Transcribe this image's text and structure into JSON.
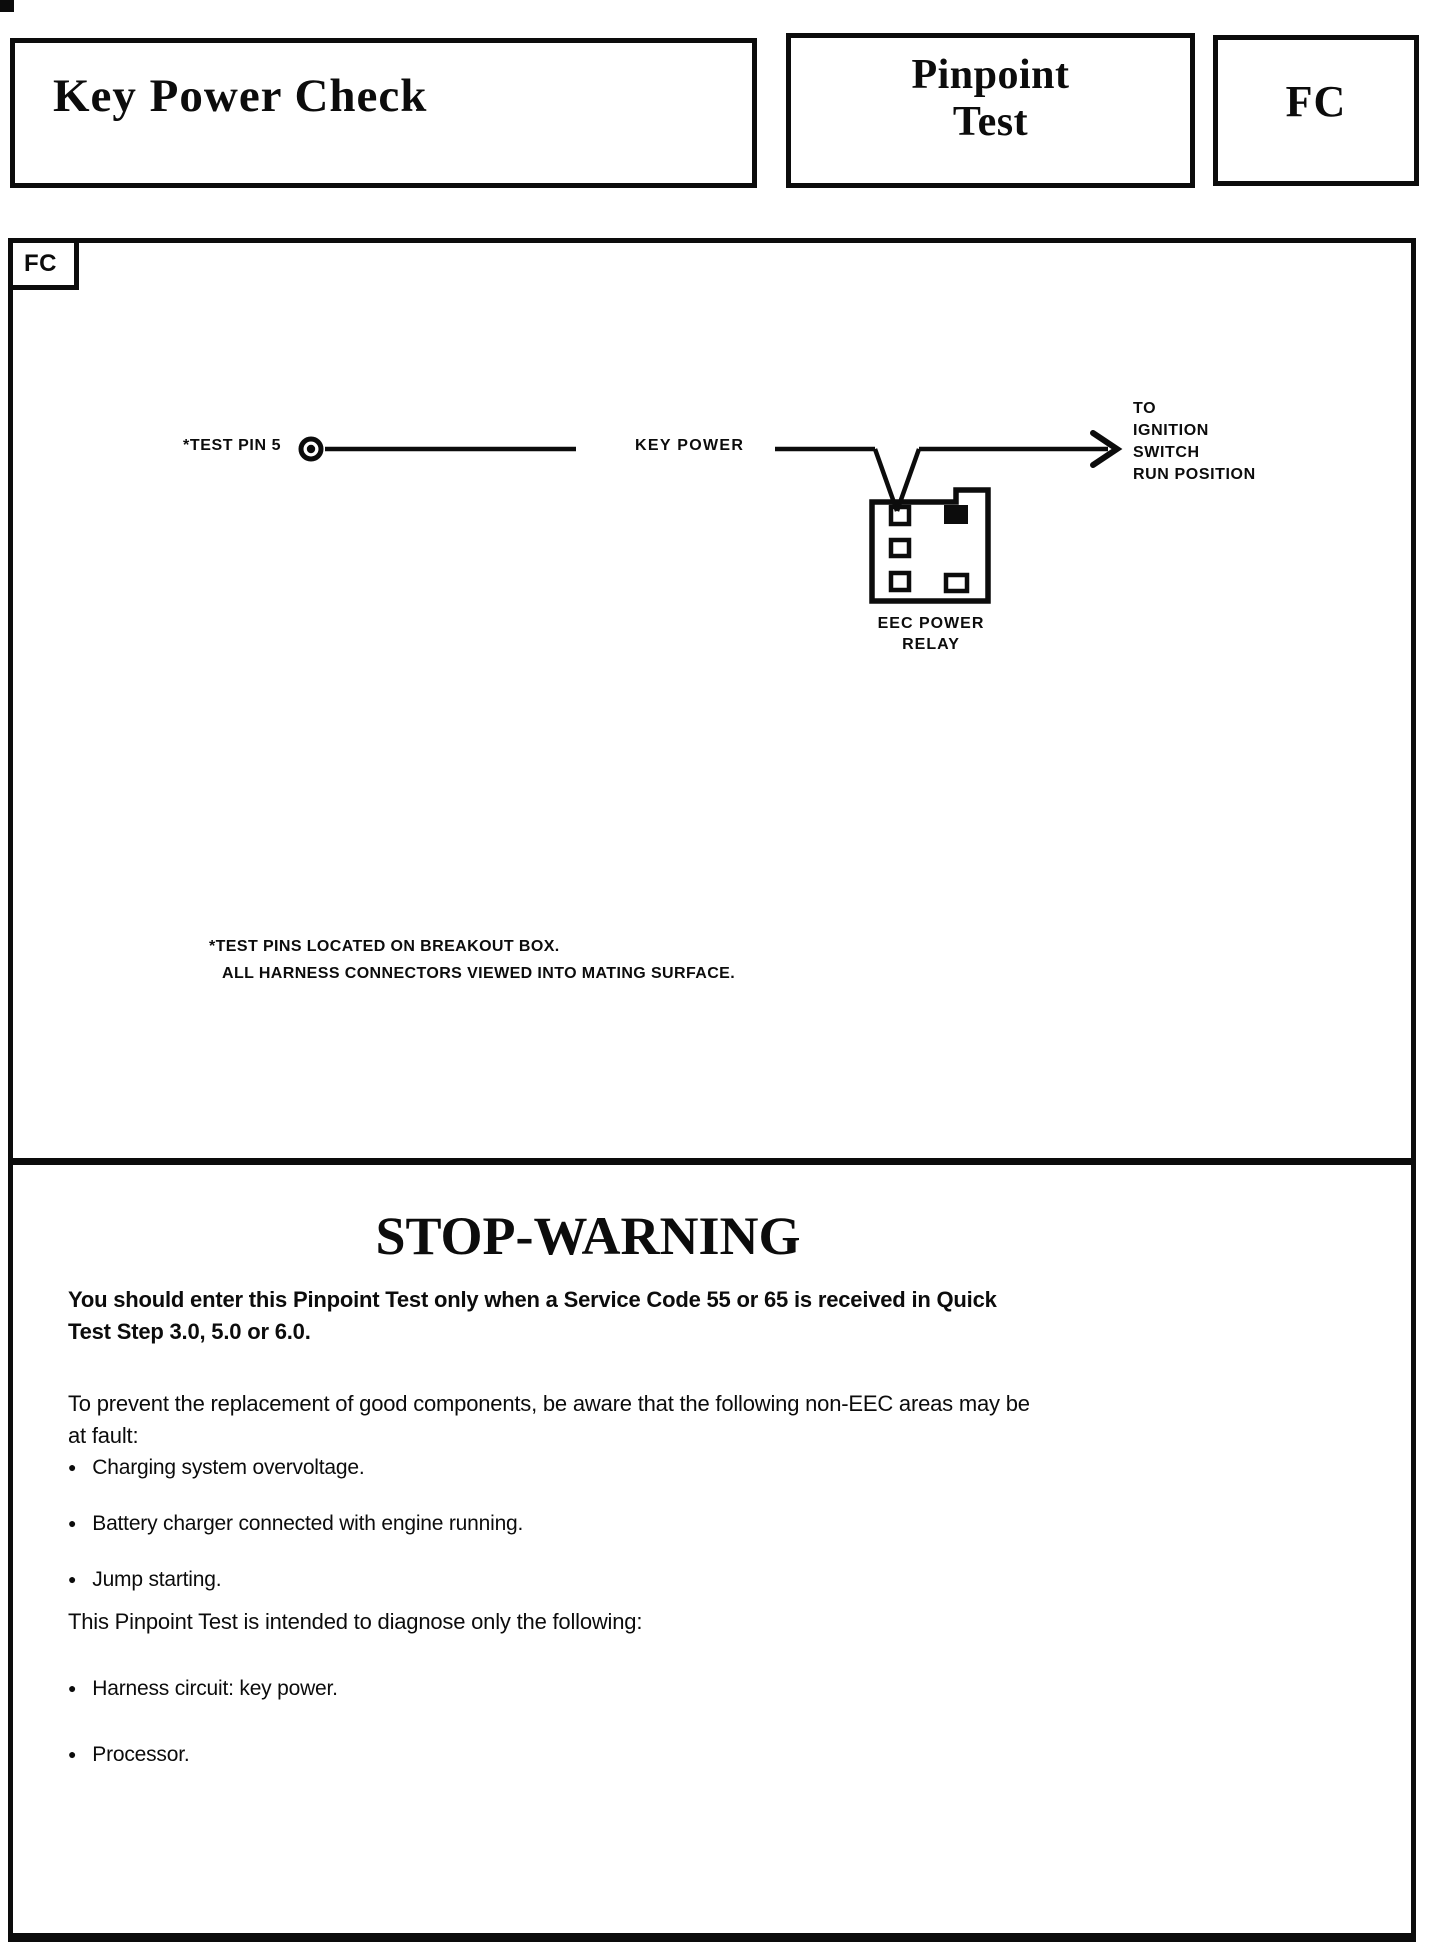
{
  "header": {
    "title": "Key Power Check",
    "test_label_lines": [
      "Pinpoint",
      "Test"
    ],
    "test_code": "FC"
  },
  "diagram": {
    "corner_code": "FC",
    "test_pin_label": "*TEST PIN 5",
    "wire_label": "KEY POWER",
    "destination_lines": [
      "TO",
      "IGNITION",
      "SWITCH",
      "RUN POSITION"
    ],
    "relay_caption_lines": [
      "EEC POWER",
      "RELAY"
    ],
    "footnote_lines": [
      "*TEST PINS LOCATED ON BREAKOUT BOX.",
      "ALL HARNESS CONNECTORS VIEWED INTO MATING SURFACE."
    ]
  },
  "warning": {
    "title": "STOP-WARNING",
    "intro_lines": [
      "You should enter this Pinpoint Test only when a Service Code 55 or 65 is received in Quick",
      "Test Step 3.0, 5.0 or 6.0."
    ],
    "prevent_lines": [
      "To prevent the replacement of good components, be aware that the following non-EEC areas may be",
      "at fault:"
    ],
    "fault_items": [
      "Charging system overvoltage.",
      "Battery charger connected with engine running.",
      "Jump starting."
    ],
    "diagnose_intro": "This Pinpoint Test is intended to diagnose only the following:",
    "diagnose_items": [
      "Harness circuit: key power.",
      "Processor."
    ]
  },
  "icons": {
    "bullet": "●"
  },
  "colors": {
    "ink": "#0c0c0c",
    "paper": "#ffffff"
  }
}
